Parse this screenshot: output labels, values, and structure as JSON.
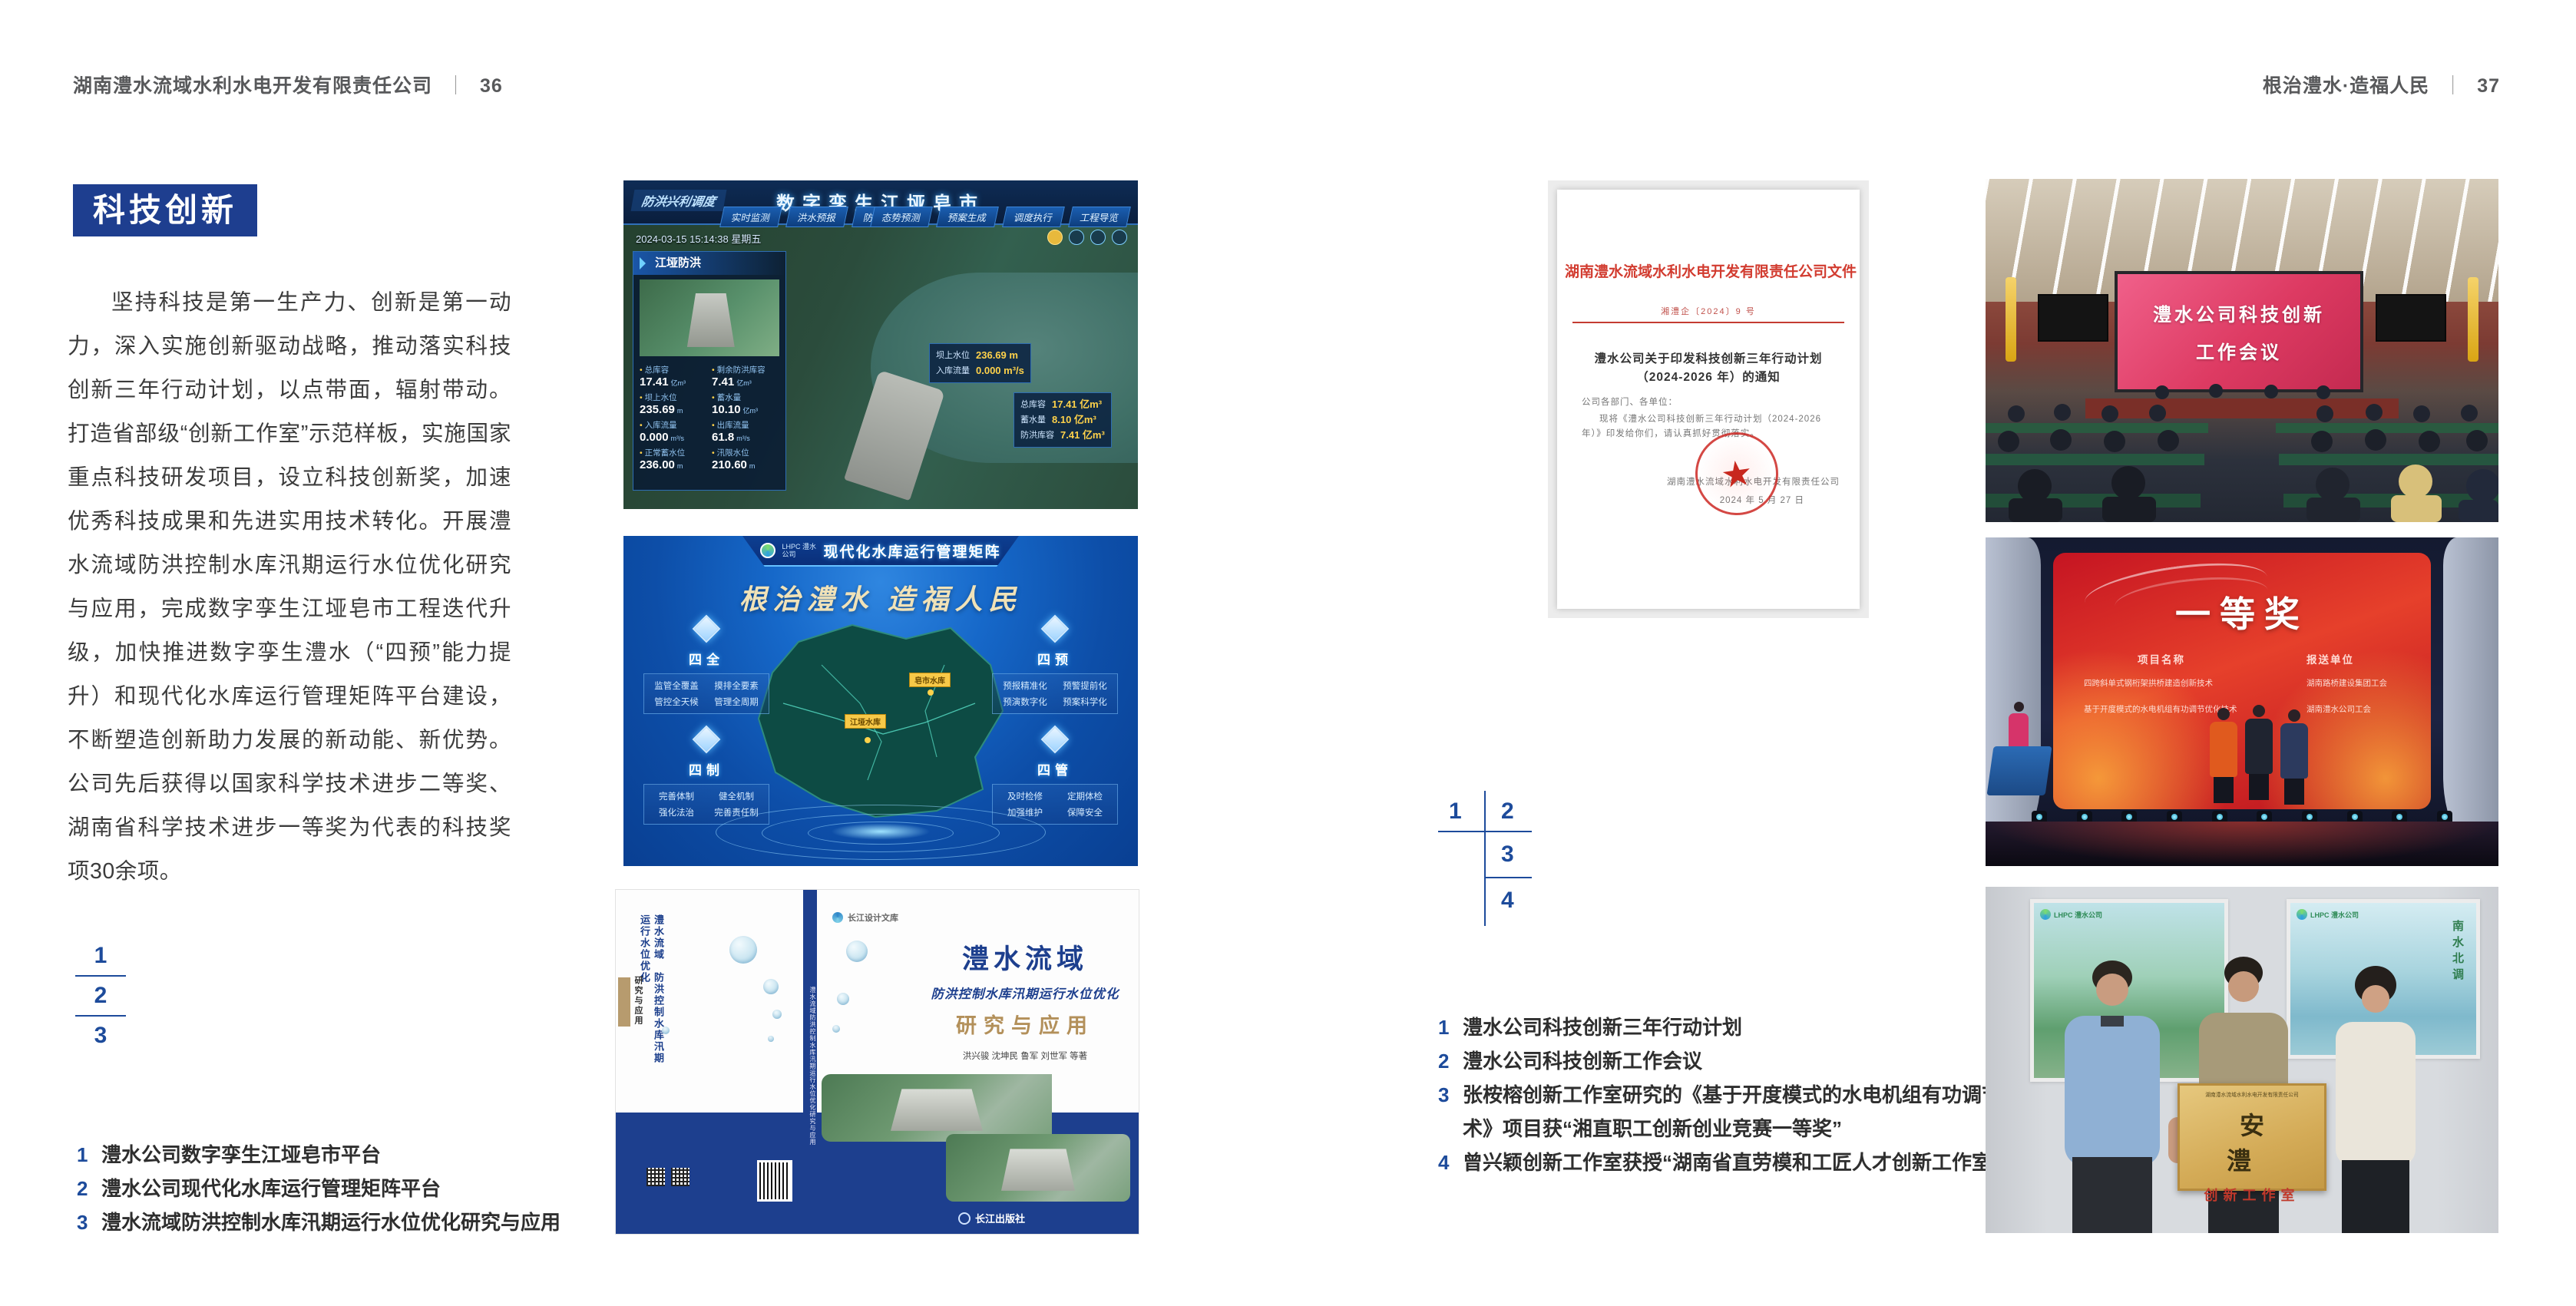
{
  "page": {
    "left_header": {
      "company": "湖南澧水流域水利水电开发有限责任公司",
      "divider": "｜",
      "page_no": "36"
    },
    "right_header": {
      "title": "根治澧水·造福人民",
      "divider": "｜",
      "page_no": "37"
    }
  },
  "section": {
    "badge": "科技创新",
    "paragraph": "坚持科技是第一生产力、创新是第一动力，深入实施创新驱动战略，推动落实科技创新三年行动计划，以点带面，辐射带动。打造省部级“创新工作室”示范样板，实施国家重点科技研发项目，设立科技创新奖，加速优秀科技成果和先进实用技术转化。开展澧水流域防洪控制水库汛期运行水位优化研究与应用，完成数字孪生江垭皂市工程迭代升级，加快推进数字孪生澧水（“四预”能力提升）和现代化水库运行管理矩阵平台建设，不断塑造创新助力发展的新动能、新优势。公司先后获得以国家科学技术进步二等奖、湖南省科学技术进步一等奖为代表的科技奖项30余项。"
  },
  "left_locator": {
    "n1": "1",
    "n2": "2",
    "n3": "3"
  },
  "left_captions": [
    {
      "no": "1",
      "text": "澧水公司数字孪生江垭皂市平台"
    },
    {
      "no": "2",
      "text": "澧水公司现代化水库运行管理矩阵平台"
    },
    {
      "no": "3",
      "text": "澧水流域防洪控制水库汛期运行水位优化研究与应用"
    }
  ],
  "right_locator": {
    "n1": "1",
    "n2": "2",
    "n3": "3",
    "n4": "4"
  },
  "right_captions": [
    {
      "no": "1",
      "text": "澧水公司科技创新三年行动计划"
    },
    {
      "no": "2",
      "text": "澧水公司科技创新工作会议"
    },
    {
      "no": "3",
      "text": "张桉榕创新工作室研究的《基于开度模式的水电机组有功调节优化技术》项目获“湘直职工创新创业竞赛一等奖”"
    },
    {
      "no": "4",
      "text": "曾兴颖创新工作室获授“湖南省直劳模和工匠人才创新工作室”"
    }
  ],
  "dashboard": {
    "corner_label": "防洪兴利调度",
    "title": "数字孪生江垭皂市",
    "tabs_left": [
      "实时监测",
      "洪水预报",
      "防洪预警"
    ],
    "tabs_right": [
      "态势预测",
      "预案生成",
      "调度执行",
      "工程导览"
    ],
    "datetime": "2024-03-15 15:14:38 星期五",
    "panel_title": "江垭防洪",
    "stats": [
      {
        "label": "总库容",
        "value": "17.41",
        "unit": "亿m³"
      },
      {
        "label": "剩余防洪库容",
        "value": "7.41",
        "unit": "亿m³"
      },
      {
        "label": "坝上水位",
        "value": "235.69",
        "unit": "m"
      },
      {
        "label": "蓄水量",
        "value": "10.10",
        "unit": "亿m³"
      },
      {
        "label": "入库流量",
        "value": "0.000",
        "unit": "m³/s"
      },
      {
        "label": "出库流量",
        "value": "61.8",
        "unit": "m³/s"
      },
      {
        "label": "正常蓄水位",
        "value": "236.00",
        "unit": "m"
      },
      {
        "label": "汛限水位",
        "value": "210.60",
        "unit": "m"
      }
    ],
    "chip_a": [
      {
        "l": "坝上水位",
        "v": "236.69 m"
      },
      {
        "l": "入库流量",
        "v": "0.000 m³/s"
      }
    ],
    "chip_b": [
      {
        "l": "总库容",
        "v": "17.41 亿m³"
      },
      {
        "l": "蓄水量",
        "v": "8.10 亿m³"
      },
      {
        "l": "防洪库容",
        "v": "7.41 亿m³"
      }
    ]
  },
  "platform": {
    "logo": "LHPC 澧水公司",
    "title": "现代化水库运行管理矩阵",
    "slogan": "根治澧水 造福人民",
    "groups": [
      {
        "name": "四全",
        "items": [
          "监管全覆盖",
          "摸排全要素",
          "管控全天候",
          "管理全周期"
        ]
      },
      {
        "name": "四预",
        "items": [
          "预报精准化",
          "预警提前化",
          "预演数字化",
          "预案科学化"
        ]
      },
      {
        "name": "四制",
        "items": [
          "完善体制",
          "健全机制",
          "强化法治",
          "完善责任制"
        ]
      },
      {
        "name": "四管",
        "items": [
          "及时检修",
          "定期体检",
          "加强维护",
          "保障安全"
        ]
      }
    ],
    "map_labels": [
      "江垭水库",
      "皂市水库"
    ]
  },
  "book": {
    "series": "长江设计文库",
    "title1": "澧水流域",
    "title2": "防洪控制水库汛期运行水位优化",
    "title3": "研究与应用",
    "authors": "洪兴骏 沈坤民 鲁军 刘世军 等著",
    "publisher": "长江出版社",
    "spine": "澧水流域防洪控制水库汛期运行水位优化研究与应用",
    "back_title1": "澧水流域",
    "back_title2": "防洪控制水库汛期运行水位优化",
    "back_title3": "研究与应用"
  },
  "document": {
    "header": "湖南澧水流域水利水电开发有限责任公司文件",
    "doc_no": "湘澧企〔2024〕9 号",
    "title1": "澧水公司关于印发科技创新三年行动计划",
    "title2": "（2024-2026 年）的通知",
    "salutation": "公司各部门、各单位：",
    "body": "现将《澧水公司科技创新三年行动计划（2024-2026 年）》印发给你们，请认真抓好贯彻落实。",
    "signer": "湖南澧水流域水利水电开发有限责任公司",
    "date": "2024 年 5 月 27 日",
    "seal_star": "★"
  },
  "meeting": {
    "screen_line1": "澧水公司科技创新",
    "screen_line2": "工作会议"
  },
  "award": {
    "title": "一等奖",
    "col1": "项目名称",
    "col2": "报送单位",
    "row1_project": "四跨斜单式钢桁架拱桥建造创新技术",
    "row1_unit": "湖南路桥建设集团工会",
    "row2_project": "基于开度模式的水电机组有功调节优化技术",
    "row2_unit": "湖南澧水公司工会"
  },
  "plaque": {
    "org_line": "湖南澧水流域水利水电开发有限责任公司",
    "title": "安 澧",
    "subtitle": "创新工作室",
    "poster_left_logo": "LHPC 澧水公司",
    "poster_right_logo": "LHPC 澧水公司",
    "poster_right_text": "南水北调"
  }
}
